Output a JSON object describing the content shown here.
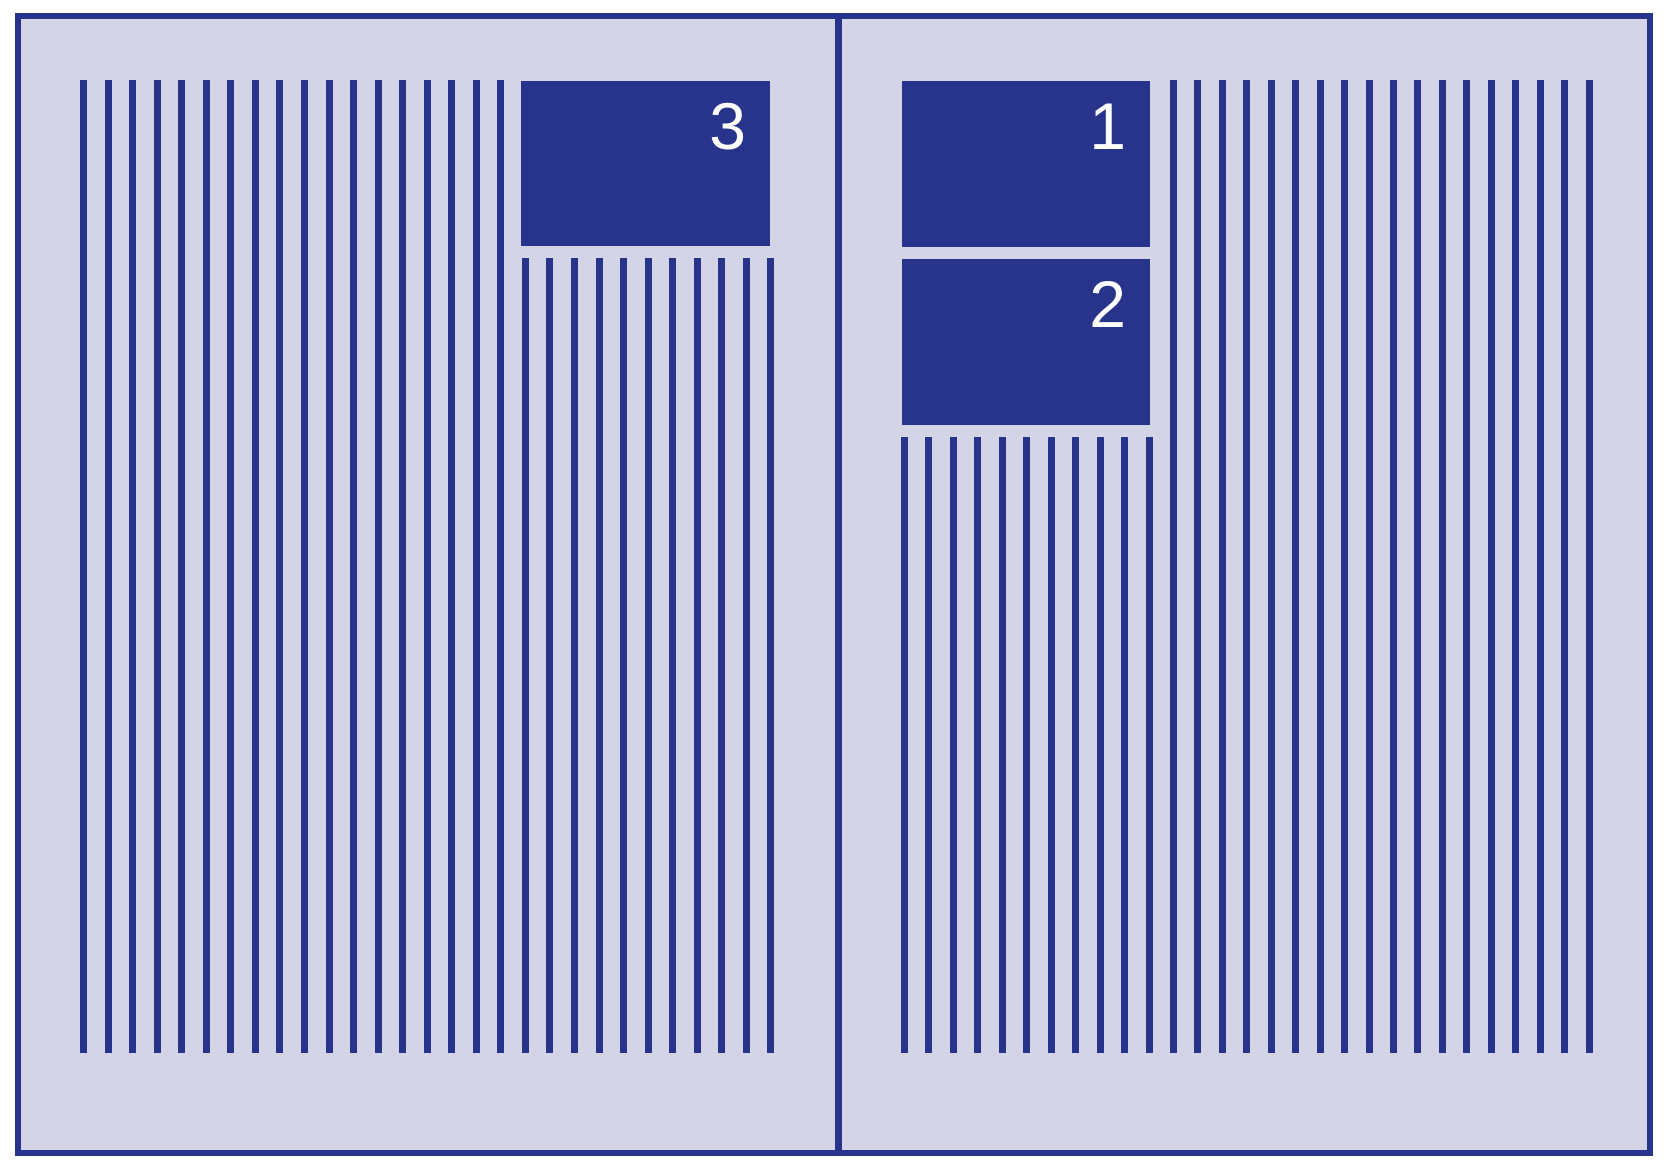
{
  "figure": {
    "description": "Two-page spread schematic: columns of vertical text-line strokes with numbered float boxes showing placement order",
    "colors": {
      "ink": "#28348b",
      "paper": "#d3d4e6",
      "label": "#ffffff",
      "canvas": "#ffffff"
    },
    "pages": [
      {
        "side": "left",
        "full_text_lines": 18,
        "short_text_lines": 11,
        "floats": [
          {
            "label": "3"
          }
        ]
      },
      {
        "side": "right",
        "short_text_lines": 11,
        "full_text_lines": 18,
        "floats": [
          {
            "label": "1"
          },
          {
            "label": "2"
          }
        ]
      }
    ]
  }
}
